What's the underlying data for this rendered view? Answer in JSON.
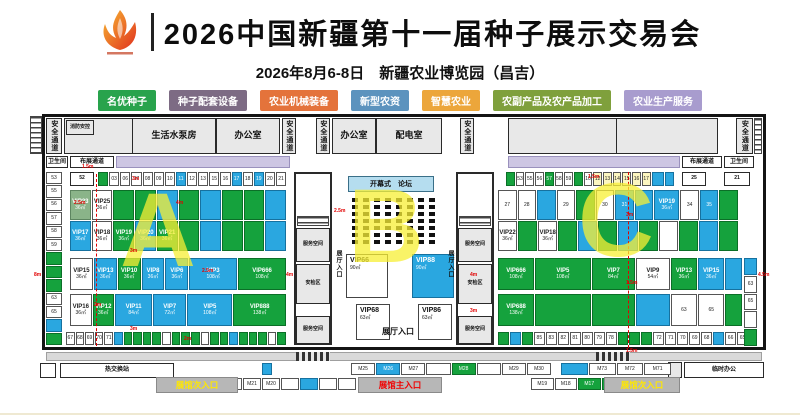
{
  "header": {
    "title": "2026中国新疆第十一届种子展示交易会",
    "subtitle": "2026年8月6-8日　新疆农业博览园（昌吉）"
  },
  "legend": [
    {
      "label": "名优种子",
      "color": "#28a34c"
    },
    {
      "label": "种子配套设备",
      "color": "#7d6b84"
    },
    {
      "label": "农业机械装备",
      "color": "#e4733b"
    },
    {
      "label": "新型农资",
      "color": "#5c93be"
    },
    {
      "label": "智慧农业",
      "color": "#eca63b"
    },
    {
      "label": "农副产品及农产品加工",
      "color": "#7fa03c"
    },
    {
      "label": "农业生产服务",
      "color": "#a89cce"
    }
  ],
  "labels": {
    "safety": "安全通道",
    "fire_ctrl": "消防安控",
    "pump_room": "生活水泵房",
    "office": "办公室",
    "power_room": "配电室",
    "toilet": "卫生间",
    "setup_corridor": "布展通道",
    "service_space": "服务空间",
    "security_zone": "安检区",
    "hall_entry": "展厅入口",
    "stage": "开幕式　论坛",
    "heat_station": "热交换站",
    "temp_office": "临时办公",
    "main_entrance": "展馆主入口",
    "side_entrance": "展馆次入口",
    "box52": "52",
    "box25": "25",
    "box21": "21"
  },
  "halls": {
    "a": "A",
    "b": "B",
    "c": "C"
  },
  "hall_a": {
    "left_col": [
      {
        "t": "53"
      },
      {
        "t": "55"
      },
      {
        "t": "56"
      },
      {
        "t": "57"
      },
      {
        "t": "58"
      },
      {
        "t": "59"
      },
      {
        "c": "g"
      },
      {
        "c": "g"
      },
      {
        "c": "g"
      },
      {
        "t": "63"
      },
      {
        "t": "65"
      },
      {
        "c": "b"
      },
      {
        "c": "g"
      }
    ],
    "row1": [
      {
        "c": "g"
      },
      {
        "t": "03"
      },
      {
        "t": "06"
      },
      {
        "t": "07"
      },
      {
        "t": "08"
      },
      {
        "t": "09"
      },
      {
        "t": "10"
      },
      {
        "t": "11",
        "c": "b"
      },
      {
        "t": "12"
      },
      {
        "t": "13"
      },
      {
        "t": "15"
      },
      {
        "t": "16"
      },
      {
        "t": "17",
        "c": "b"
      },
      {
        "t": "18"
      },
      {
        "t": "19",
        "c": "b"
      },
      {
        "t": "20"
      },
      {
        "t": "21"
      }
    ],
    "vip_upper": [
      {
        "t": "VIP23",
        "s": "36㎡",
        "c": "lg"
      },
      {
        "t": "VIP25",
        "s": "36㎡"
      },
      {
        "c": "g"
      },
      {
        "c": "g"
      },
      {
        "c": "b"
      },
      {
        "c": "g"
      },
      {
        "c": "b"
      },
      {
        "c": "g"
      },
      {
        "c": "g"
      },
      {
        "c": "b"
      }
    ],
    "vip_lower": [
      {
        "t": "VIP17",
        "s": "36㎡",
        "c": "b"
      },
      {
        "t": "VIP18",
        "s": "36㎡"
      },
      {
        "t": "VIP19",
        "s": "36㎡",
        "c": "g"
      },
      {
        "t": "VIP20",
        "s": "36㎡",
        "c": "b"
      },
      {
        "t": "VIP21",
        "s": "36㎡",
        "c": "g"
      },
      {
        "c": "g"
      },
      {
        "c": "b"
      },
      {
        "c": "g"
      },
      {
        "c": "g"
      },
      {
        "c": "b"
      }
    ],
    "row3": [
      {
        "t": "VIP15",
        "s": "36㎡"
      },
      {
        "t": "VIP13",
        "s": "36㎡",
        "c": "b"
      },
      {
        "t": "VIP10",
        "s": "36㎡",
        "c": "g"
      },
      {
        "t": "VIP8",
        "s": "36㎡",
        "c": "b"
      },
      {
        "t": "VIP6",
        "s": "36㎡",
        "c": "b"
      },
      {
        "t": "VIP3",
        "s": "108㎡",
        "c": "b",
        "w": 2.2
      },
      {
        "t": "VIP666",
        "s": "108㎡",
        "c": "g",
        "w": 2.2
      }
    ],
    "row4": [
      {
        "t": "VIP16",
        "s": "36㎡"
      },
      {
        "t": "VIP12",
        "s": "36㎡",
        "c": "g"
      },
      {
        "t": "VIP11",
        "s": "84㎡",
        "c": "b",
        "w": 1.8
      },
      {
        "t": "VIP7",
        "s": "72㎡",
        "c": "b",
        "w": 1.6
      },
      {
        "t": "VIP5",
        "s": "108㎡",
        "c": "b",
        "w": 2.2
      },
      {
        "t": "VIP888",
        "s": "138㎡",
        "c": "g",
        "w": 2.6
      }
    ],
    "row5": [
      {
        "t": "67"
      },
      {
        "t": "68"
      },
      {
        "t": "69"
      },
      {
        "t": "70"
      },
      {
        "t": "71"
      },
      {
        "c": "b"
      },
      {
        "c": "g"
      },
      {
        "c": "g"
      },
      {
        "c": "g"
      },
      {
        "c": "g"
      },
      {},
      {
        "c": "g"
      },
      {
        "c": "g"
      },
      {
        "c": "g"
      },
      {},
      {
        "c": "g"
      },
      {
        "c": "g"
      },
      {
        "c": "b"
      },
      {
        "c": "g"
      },
      {
        "c": "g"
      },
      {
        "c": "g"
      },
      {},
      {
        "c": "g"
      }
    ]
  },
  "hall_b": {
    "seat_rows": 7,
    "seat_cols": 8,
    "vip66": {
      "t": "VIP66",
      "s": "90㎡"
    },
    "vip88": {
      "t": "VIP88",
      "s": "90㎡"
    },
    "vip68": {
      "t": "VIP68",
      "s": "63㎡"
    },
    "vip86": {
      "t": "VIP86",
      "s": "63㎡"
    }
  },
  "hall_c": {
    "row1": [
      {
        "c": "g"
      },
      {
        "t": "53"
      },
      {
        "t": "55"
      },
      {
        "t": "56"
      },
      {
        "t": "57",
        "c": "g"
      },
      {
        "t": "58"
      },
      {
        "t": "59"
      },
      {
        "c": "g"
      },
      {
        "t": "10"
      },
      {
        "t": "12",
        "c": "y"
      },
      {
        "t": "13",
        "c": "y"
      },
      {
        "t": "14",
        "c": "y"
      },
      {
        "t": "15",
        "c": "y"
      },
      {
        "t": "16",
        "c": "y"
      },
      {
        "t": "17",
        "c": "y"
      },
      {
        "c": "b",
        "w": 1.6
      },
      {
        "c": "b"
      }
    ],
    "vip_upper": [
      {
        "t": "27"
      },
      {
        "t": "28"
      },
      {
        "c": "b"
      },
      {
        "t": "29"
      },
      {
        "c": "g"
      },
      {
        "t": "30"
      },
      {
        "t": "31",
        "c": "b"
      },
      {
        "c": "b"
      },
      {
        "t": "VIP19",
        "s": "36㎡",
        "c": "b",
        "w": 1.4
      },
      {
        "t": "34"
      },
      {
        "t": "35",
        "c": "b"
      },
      {
        "c": "g"
      }
    ],
    "vip_lower": [
      {
        "t": "VIP22",
        "s": "36㎡"
      },
      {
        "c": "g"
      },
      {
        "t": "VIP18",
        "s": "36㎡"
      },
      {
        "c": "g"
      },
      {
        "c": "b"
      },
      {
        "c": "g"
      },
      {
        "c": "b"
      },
      {
        "c": "g"
      },
      {},
      {
        "c": "g"
      },
      {
        "c": "b"
      },
      {
        "c": "g"
      }
    ],
    "row3": [
      {
        "t": "VIP666",
        "s": "108㎡",
        "c": "g",
        "w": 1.4
      },
      {
        "t": "VIP5",
        "s": "108㎡",
        "c": "g",
        "w": 2.2
      },
      {
        "t": "VIP7",
        "s": "84㎡",
        "c": "g",
        "w": 1.7
      },
      {
        "t": "VIP9",
        "s": "54㎡",
        "w": 1.3
      },
      {
        "t": "VIP13",
        "s": "36㎡",
        "c": "g"
      },
      {
        "t": "VIP15",
        "s": "36㎡",
        "c": "b"
      },
      {
        "c": "b",
        "w": 0.6
      }
    ],
    "row4": [
      {
        "t": "VIP688",
        "s": "138㎡",
        "c": "g",
        "w": 1.4
      },
      {
        "c": "g",
        "w": 2.2
      },
      {
        "c": "g",
        "w": 1.7
      },
      {
        "c": "b",
        "w": 1.3
      },
      {
        "t": "63"
      },
      {
        "t": "65"
      },
      {
        "c": "g",
        "w": 0.6
      }
    ],
    "row5": [
      {
        "c": "g"
      },
      {
        "c": "b"
      },
      {
        "c": "g"
      },
      {
        "t": "85"
      },
      {
        "t": "83"
      },
      {
        "t": "82"
      },
      {
        "t": "81"
      },
      {
        "t": "80"
      },
      {
        "t": "79"
      },
      {
        "t": "78"
      },
      {
        "c": "g"
      },
      {
        "c": "g"
      },
      {
        "c": "g"
      },
      {
        "t": "72"
      },
      {
        "t": "71"
      },
      {
        "t": "70"
      },
      {
        "t": "69"
      },
      {
        "t": "68"
      },
      {
        "c": "b"
      },
      {
        "t": "66"
      },
      {
        "t": "65"
      }
    ],
    "right_col": [
      {
        "c": "b"
      },
      {
        "t": "63"
      },
      {
        "t": "65"
      },
      {},
      {
        "c": "g"
      }
    ]
  },
  "bottom": {
    "m_row1": [
      {
        "t": "M25"
      },
      {
        "t": "M26",
        "c": "b"
      },
      {
        "t": "M27"
      },
      {},
      {
        "t": "M28",
        "c": "g"
      },
      {},
      {
        "t": "M29"
      },
      {
        "t": "M30"
      }
    ],
    "m_row2": [
      {
        "c": "b"
      },
      {
        "t": "M73"
      },
      {
        "t": "M72"
      },
      {
        "t": "M71"
      }
    ],
    "m_row3": [
      {},
      {},
      {
        "t": "M22"
      },
      {
        "t": "M21"
      },
      {
        "t": "M20"
      },
      {},
      {
        "c": "b"
      },
      {},
      {}
    ],
    "m_row4": [
      {
        "t": "M19"
      },
      {
        "t": "M18"
      },
      {
        "t": "M17",
        "c": "g"
      },
      {
        "t": "M16",
        "c": "g"
      },
      {
        "c": "b"
      },
      {
        "t": "M12",
        "c": "g"
      }
    ]
  },
  "dims": [
    {
      "x": 46,
      "y": 52,
      "t": "1.5m"
    },
    {
      "x": 96,
      "y": 64,
      "t": "3m"
    },
    {
      "x": 38,
      "y": 88,
      "t": "2.5m"
    },
    {
      "x": 140,
      "y": 88,
      "t": "4m"
    },
    {
      "x": -2,
      "y": 160,
      "t": "8m"
    },
    {
      "x": 250,
      "y": 160,
      "t": "4m"
    },
    {
      "x": 166,
      "y": 156,
      "t": "2.5m"
    },
    {
      "x": 94,
      "y": 136,
      "t": "3m"
    },
    {
      "x": 58,
      "y": 190,
      "t": "2m"
    },
    {
      "x": 94,
      "y": 214,
      "t": "3m"
    },
    {
      "x": 148,
      "y": 224,
      "t": "2m"
    },
    {
      "x": 552,
      "y": 62,
      "t": "1.5m"
    },
    {
      "x": 590,
      "y": 100,
      "t": "3m"
    },
    {
      "x": 590,
      "y": 168,
      "t": "1.5m"
    },
    {
      "x": 722,
      "y": 160,
      "t": "4.5m"
    },
    {
      "x": 434,
      "y": 160,
      "t": "4m"
    },
    {
      "x": 434,
      "y": 196,
      "t": "3m"
    },
    {
      "x": 298,
      "y": 96,
      "t": "2.5m"
    },
    {
      "x": 590,
      "y": 236,
      "t": "1.5m"
    }
  ]
}
